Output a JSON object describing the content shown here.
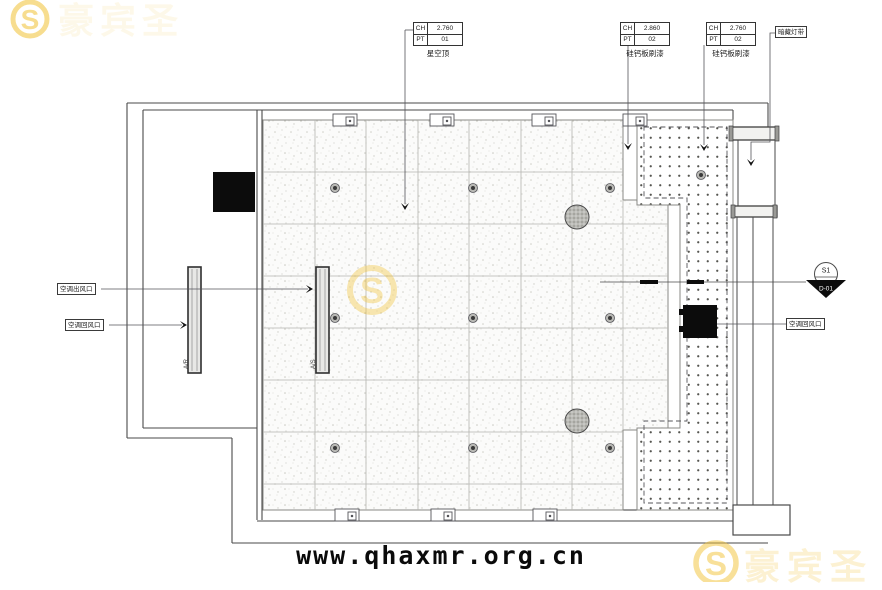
{
  "title_labels": {
    "top": [
      {
        "ch_key": "CH",
        "ch_val": "2.760",
        "pt_key": "PT",
        "pt_val": "01",
        "caption": "星空顶"
      },
      {
        "ch_key": "CH",
        "ch_val": "2.860",
        "pt_key": "PT",
        "pt_val": "02",
        "caption": "硅钙板刷漆"
      },
      {
        "ch_key": "CH",
        "ch_val": "2.760",
        "pt_key": "PT",
        "pt_val": "02",
        "caption": "硅钙板刷漆"
      }
    ],
    "light_strip": "暗藏灯带"
  },
  "hvac_labels": {
    "supply_outlet": "空调出风口",
    "return_left": "空调回风口",
    "return_right": "空调回风口",
    "vent_return": "A/R",
    "vent_supply": "A/S"
  },
  "section_marker": {
    "code": "S1",
    "detail": "D-01"
  },
  "watermark": {
    "domain": "www.qhaxmr.org.cn",
    "brand": "豪宾圣",
    "monogram": "S"
  },
  "colors": {
    "line": "#4a4a4a",
    "grid_line": "#b5b5b0",
    "gold": "#F2C335",
    "black_fill": "#0c0c0c"
  }
}
